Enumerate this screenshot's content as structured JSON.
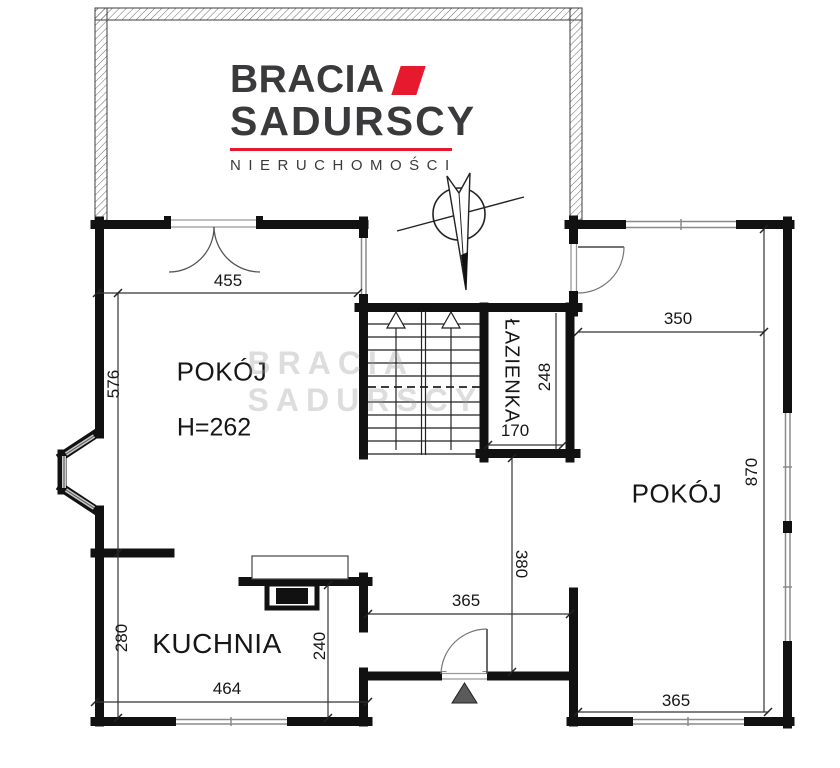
{
  "brand": {
    "name_line1": "BRACIA",
    "name_line2": "SADURSCY",
    "tagline": "NIERUCHOMOŚCI"
  },
  "watermark": "BRACIA SADURSCY",
  "rooms": {
    "room_top_left": {
      "label": "POKÓJ",
      "ceiling": "H=262"
    },
    "room_right": {
      "label": "POKÓJ"
    },
    "kitchen": {
      "label": "KUCHNIA"
    },
    "bathroom": {
      "label": "ŁAZIENKA"
    }
  },
  "dims": {
    "room_left_width": "455",
    "room_left_depth": "576",
    "room_right_width": "350",
    "room_right_depth": "870",
    "room_right_bottom_width": "365",
    "bathroom_depth": "248",
    "bathroom_width": "170",
    "hall_width": "365",
    "hall_depth": "380",
    "kitchen_depth_left": "280",
    "kitchen_depth_right": "240",
    "kitchen_width": "464"
  },
  "colors": {
    "brand_accent": "#e6192e",
    "brand_text": "#3a3a3c",
    "wall": "#111111",
    "window_gray": "#8a8a8a",
    "entrance_marker": "#5a5a5a"
  }
}
